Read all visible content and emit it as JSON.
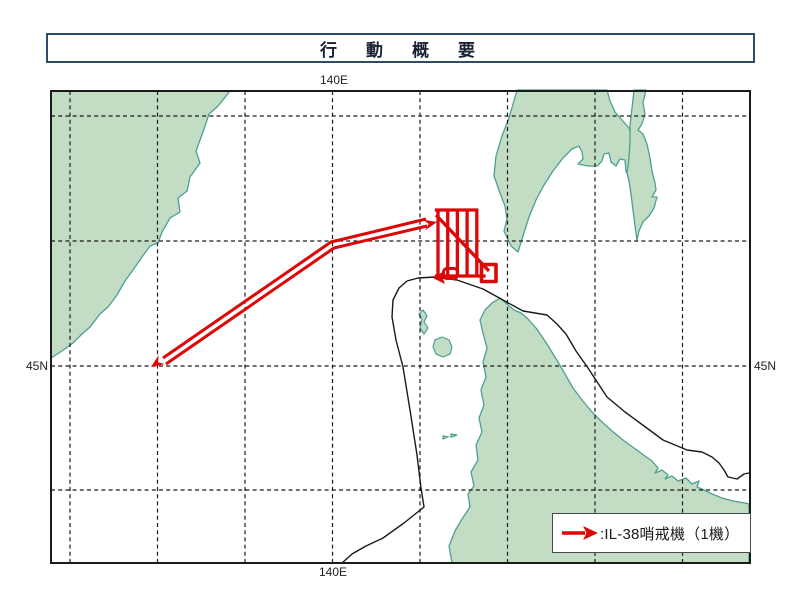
{
  "title": "行　動　概　要",
  "map": {
    "labels": {
      "longitude_top": "140E",
      "longitude_bottom": "140E",
      "latitude_left": "45N",
      "latitude_right": "45N"
    },
    "colors": {
      "land_fill": "#c3ddc5",
      "coast_stroke": "#4d9f93",
      "route_red": "#dd0707",
      "frame_navy": "#31496b",
      "line_black": "#1a1a1a"
    },
    "geometry": {
      "grid_vertical_d": "M70,91 V563 M157.5,91 V563 M245,91 V563 M332.5,91 V563 M420,91 V563 M507.5,91 V563 M595,91 V563 M682.5,91 V563",
      "grid_horizontal_d": "M51,116 H750 M51,241 H750 M51,366 H750 M51,490 H750",
      "land_continent_d": "M51,91 L230,91 L218,106 L209,114 L204,129 L196,151 L200,163 L190,177 L187,191 L178,198 L180,212 L170,218 L162,232 L158,243 L150,246 L142,257 L133,270 L125,281 L117,295 L108,307 L100,314 L90,327 L82,334 L73,343 L62,351 L51,358 Z",
      "land_sakhalin_west_d": "M517,90 L509,118 L502,136 L496,156 L494,176 L500,193 L505,206 L507,219 L504,231 L511,246 L518,252 L523,236 L529,217 L536,200 L544,185 L553,171 L563,158 L572,149 L579,146 L582,152 L583,159 L578,164 L588,166 L597,166 L602,161 L604,154 L609,153 L611,162 L616,166 L620,159 L625,160 L626,172 L632,175 L637,169 L639,161 L636,148 L632,137 L629,128 L622,120 L615,112 L610,101 L607,90 Z",
      "land_sakhalin_east_d": "M634,90 L646,90 L643,103 L645,114 L642,124 L638,130 L643,134 L647,144 L650,158 L652,171 L655,183 L656,190 L652,197 L657,197 L654,208 L649,216 L643,222 L639,231 L637,240 L635,226 L633,210 L631,194 L629,181 L627,173 L629,158 L630,142 L630,126 L632,108 Z",
      "land_hokkaido_d": "M452,563 L449,546 L455,531 L462,519 L470,507 L468,494 L474,486 L471,472 L478,460 L476,445 L482,432 L479,418 L484,405 L481,390 L486,377 L483,362 L487,348 L483,333 L480,320 L485,310 L492,303 L500,298 L507,304 L514,310 L521,313 L528,319 L536,328 L543,338 L550,349 L558,362 L565,374 L573,388 L582,400 L592,412 L602,422 L612,431 L623,440 L634,448 L645,456 L652,461 L658,468 L655,473 L662,470 L668,475 L665,479 L672,476 L678,481 L686,478 L692,484 L699,481 L697,487 L704,490 L712,494 L722,498 L733,501 L745,503 L749,504 L749,563 Z",
      "island_rebun_d": "M423,310 L427,316 L424,322 L428,328 L424,334 L420,328 L422,319 L419,314 Z",
      "island_rishiri_d": "M442,337 L449,340 L452,347 L450,354 L443,357 L436,354 L433,347 L435,340 Z",
      "islets_d": "M443,436 l5,1 -5,2 z M451,434 l6,1 -6,2 z",
      "boundary_line_d": "M342,563 L352,554 L366,546 L383,538 L404,523 L419,511 L424,507 L421,488 L417,455 L410,410 L403,367 L396,340 L392,317 L393,300 L399,288 L407,281 L418,278 L435,277 L457,280 L483,289 L503,300 L523,311 L547,315 L557,324 L566,334 L576,351 L588,368 L607,397 L625,412 L640,423 L663,440 L687,450 L702,452 L712,457 L719,463 L724,470 L728,477 L737,479 L744,474 L749,473"
    }
  },
  "flight": {
    "aircraft_label": "IL-38哨戒機（1機）",
    "outbound_d": "M163,358 L331,242 L426,219",
    "return_d": "M166,364 L334,248 L427,226",
    "arrowhead_ne_points": "437,222 422.8,219.6 428.7,223.9 425.2,230.4",
    "arrowhead_sw_points": "151,367 158.6,355.1 158,362.2 164.8,364.1",
    "pattern_bars_d": "M438,210 V276 M447.7,210 V276 M457.4,210 V276 M467.1,210 V276 M476.8,210 V276 M436.5,210 H476.8 M436.5,276 H484",
    "pattern_diagonal_d": "M436,215 L489,271",
    "pattern_loop_d": "M447,268.5 h7 a3.5,3.5 0 0 1 3.5,3.5 v3 a3.5,3.5 0 0 1 -3.5,3.5 h-7 a3.5,3.5 0 0 1 -3.5,-3.5 v-3 a3.5,3.5 0 0 1 3.5,-3.5 Z",
    "pattern_square_d": "M481.5,264.5 h14.5 v17 h-14.5 Z",
    "pattern_arrowhead_points": "433,278 445,270.5 442.5,277.5 445,284"
  },
  "legend": {
    "text": ":IL-38哨戒機（1機）",
    "arrow_shaft_d": "M2,10 H25",
    "arrow_head_points": "38,10 23,3 26.5,10 23,17"
  }
}
